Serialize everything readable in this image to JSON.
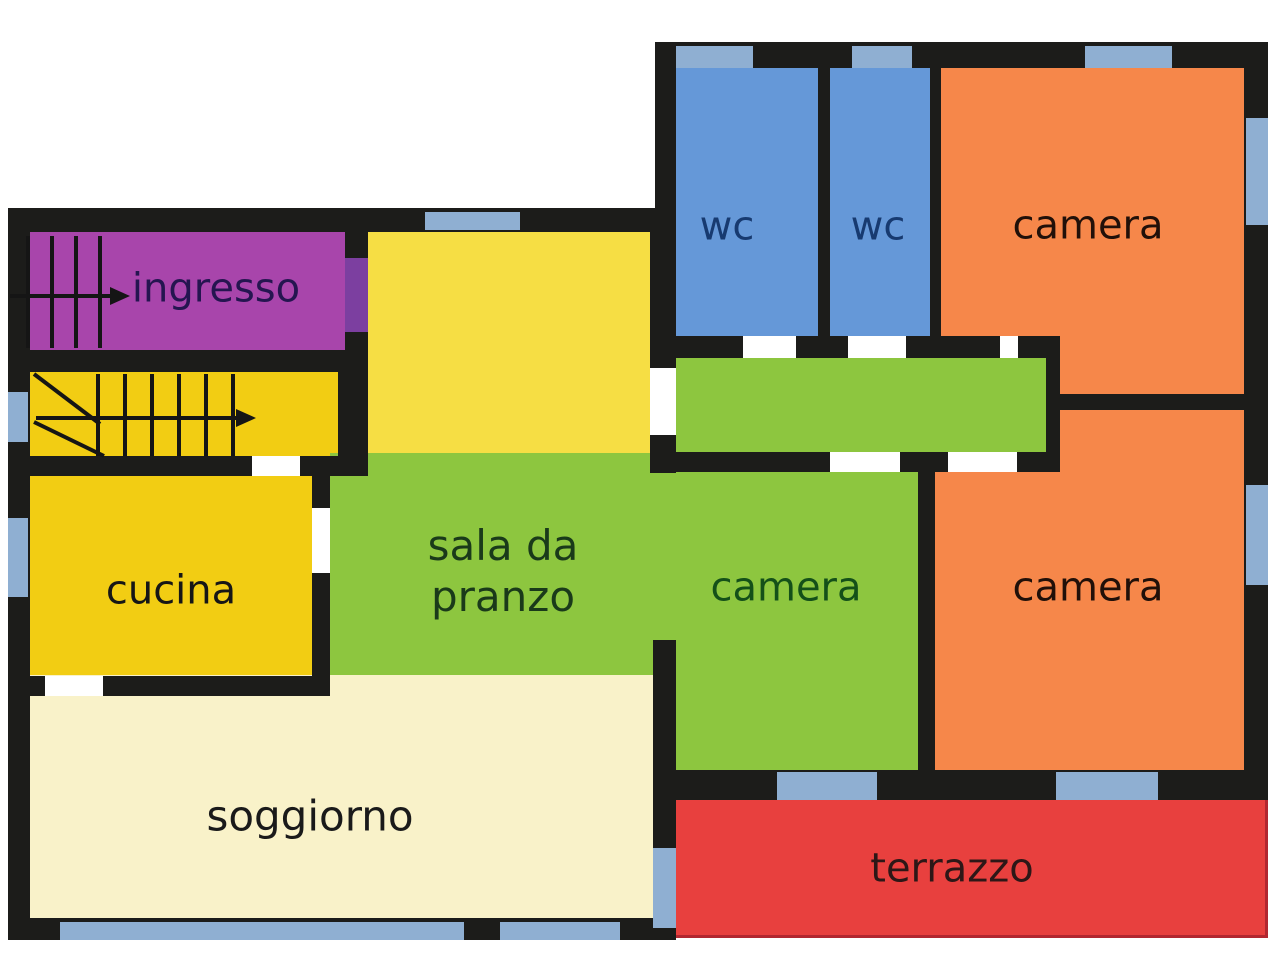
{
  "plan": {
    "width": 1280,
    "height": 960,
    "background": "#ffffff",
    "palette": {
      "wall": "#1c1c1a",
      "door_gap": "#ffffff",
      "window": "#8fafd2",
      "stair_line": "#151515",
      "purple": "#a845ab",
      "purple_door": "#7c3fa0",
      "gold": "#f2cd13",
      "light_yellow": "#f6de44",
      "green": "#8dc63f",
      "wc_blue": "#6598d8",
      "orange": "#f6874a",
      "red": "#e8403e",
      "cream": "#f9f2c9"
    }
  },
  "rooms": [
    {
      "id": "ingresso",
      "x": 20,
      "y": 230,
      "w": 325,
      "h": 122,
      "color": "#a845ab"
    },
    {
      "id": "upper-room",
      "x": 368,
      "y": 228,
      "w": 285,
      "h": 227,
      "color": "#f6de44"
    },
    {
      "id": "stairwell",
      "x": 30,
      "y": 372,
      "w": 308,
      "h": 86,
      "color": "#f2cd13"
    },
    {
      "id": "cucina",
      "x": 30,
      "y": 474,
      "w": 282,
      "h": 204,
      "color": "#f2cd13"
    },
    {
      "id": "sala-e-camera",
      "x": 330,
      "y": 453,
      "w": 588,
      "h": 322,
      "color": "#8dc63f"
    },
    {
      "id": "wc-1",
      "x": 676,
      "y": 68,
      "w": 142,
      "h": 268,
      "color": "#6598d8"
    },
    {
      "id": "wc-2",
      "x": 830,
      "y": 68,
      "w": 100,
      "h": 268,
      "color": "#6598d8"
    },
    {
      "id": "camera-top",
      "x": 941,
      "y": 68,
      "w": 303,
      "h": 330,
      "color": "#f6874a"
    },
    {
      "id": "camera-bottom",
      "x": 935,
      "y": 410,
      "w": 309,
      "h": 360,
      "color": "#f6874a"
    },
    {
      "id": "corridor",
      "x": 676,
      "y": 356,
      "w": 370,
      "h": 98,
      "color": "#8dc63f"
    },
    {
      "id": "soggiorno",
      "x": 30,
      "y": 675,
      "w": 623,
      "h": 245,
      "color": "#f9f2c9"
    },
    {
      "id": "terrazzo",
      "x": 676,
      "y": 798,
      "w": 592,
      "h": 140,
      "color": "#e8403e",
      "edge": "#b22730"
    }
  ],
  "labels": [
    {
      "id": "ingresso-label",
      "lines": [
        "ingresso"
      ],
      "x": 216,
      "y": 289,
      "color": "#251550",
      "size": 40
    },
    {
      "id": "cucina-label",
      "lines": [
        "cucina"
      ],
      "x": 171,
      "y": 591,
      "color": "#161616",
      "size": 40
    },
    {
      "id": "sala-pranzo-label",
      "lines": [
        "sala da",
        "pranzo"
      ],
      "x": 503,
      "y": 571,
      "color": "#1a3a1a",
      "size": 42
    },
    {
      "id": "camera-green-label",
      "lines": [
        "camera"
      ],
      "x": 786,
      "y": 588,
      "color": "#145019",
      "size": 40
    },
    {
      "id": "camera-orange-label",
      "lines": [
        "camera"
      ],
      "x": 1088,
      "y": 588,
      "color": "#211009",
      "size": 40
    },
    {
      "id": "camera-top-label",
      "lines": [
        "camera"
      ],
      "x": 1088,
      "y": 226,
      "color": "#211009",
      "size": 40
    },
    {
      "id": "wc-1-label",
      "lines": [
        "wc"
      ],
      "x": 727,
      "y": 227,
      "color": "#173a70",
      "size": 40
    },
    {
      "id": "wc-2-label",
      "lines": [
        "wc"
      ],
      "x": 878,
      "y": 227,
      "color": "#173a70",
      "size": 40
    },
    {
      "id": "soggiorno-label",
      "lines": [
        "soggiorno"
      ],
      "x": 310,
      "y": 816,
      "color": "#1a1a1a",
      "size": 42
    },
    {
      "id": "terrazzo-label",
      "lines": [
        "terrazzo"
      ],
      "x": 952,
      "y": 869,
      "color": "#2d1717",
      "size": 40
    }
  ],
  "walls": [
    {
      "x": 8,
      "y": 208,
      "w": 647,
      "h": 24
    },
    {
      "x": 8,
      "y": 208,
      "w": 22,
      "h": 732
    },
    {
      "x": 8,
      "y": 350,
      "w": 337,
      "h": 22
    },
    {
      "x": 345,
      "y": 230,
      "w": 23,
      "h": 120
    },
    {
      "x": 338,
      "y": 350,
      "w": 30,
      "h": 108
    },
    {
      "x": 8,
      "y": 456,
      "w": 360,
      "h": 20
    },
    {
      "x": 312,
      "y": 474,
      "w": 18,
      "h": 204
    },
    {
      "x": 8,
      "y": 676,
      "w": 322,
      "h": 20
    },
    {
      "x": 8,
      "y": 918,
      "w": 668,
      "h": 22
    },
    {
      "x": 653,
      "y": 640,
      "w": 23,
      "h": 300
    },
    {
      "x": 650,
      "y": 208,
      "w": 26,
      "h": 160
    },
    {
      "x": 650,
      "y": 435,
      "w": 26,
      "h": 38
    },
    {
      "x": 655,
      "y": 42,
      "w": 613,
      "h": 26
    },
    {
      "x": 1244,
      "y": 42,
      "w": 24,
      "h": 758
    },
    {
      "x": 655,
      "y": 42,
      "w": 21,
      "h": 168
    },
    {
      "x": 818,
      "y": 68,
      "w": 12,
      "h": 268
    },
    {
      "x": 930,
      "y": 68,
      "w": 11,
      "h": 270
    },
    {
      "x": 655,
      "y": 336,
      "w": 405,
      "h": 22
    },
    {
      "x": 1046,
      "y": 336,
      "w": 14,
      "h": 118
    },
    {
      "x": 1046,
      "y": 394,
      "w": 198,
      "h": 16
    },
    {
      "x": 655,
      "y": 452,
      "w": 405,
      "h": 20
    },
    {
      "x": 918,
      "y": 472,
      "w": 17,
      "h": 300
    },
    {
      "x": 655,
      "y": 770,
      "w": 589,
      "h": 30
    }
  ],
  "door_gaps": [
    {
      "x": 252,
      "y": 456,
      "w": 48,
      "h": 20
    },
    {
      "x": 312,
      "y": 508,
      "w": 18,
      "h": 65
    },
    {
      "x": 45,
      "y": 676,
      "w": 58,
      "h": 20
    },
    {
      "x": 650,
      "y": 368,
      "w": 26,
      "h": 67
    },
    {
      "x": 743,
      "y": 336,
      "w": 53,
      "h": 22
    },
    {
      "x": 848,
      "y": 336,
      "w": 58,
      "h": 22
    },
    {
      "x": 1000,
      "y": 336,
      "w": 18,
      "h": 22
    },
    {
      "x": 830,
      "y": 452,
      "w": 70,
      "h": 20
    },
    {
      "x": 948,
      "y": 452,
      "w": 69,
      "h": 20
    }
  ],
  "windows": [
    {
      "x": 425,
      "y": 212,
      "w": 95,
      "h": 18
    },
    {
      "x": 8,
      "y": 392,
      "w": 20,
      "h": 50
    },
    {
      "x": 8,
      "y": 518,
      "w": 20,
      "h": 79
    },
    {
      "x": 60,
      "y": 922,
      "w": 404,
      "h": 18
    },
    {
      "x": 500,
      "y": 922,
      "w": 120,
      "h": 18
    },
    {
      "x": 653,
      "y": 848,
      "w": 23,
      "h": 80
    },
    {
      "x": 676,
      "y": 46,
      "w": 77,
      "h": 22
    },
    {
      "x": 852,
      "y": 46,
      "w": 60,
      "h": 22
    },
    {
      "x": 1085,
      "y": 46,
      "w": 87,
      "h": 22
    },
    {
      "x": 1246,
      "y": 118,
      "w": 22,
      "h": 107
    },
    {
      "x": 1246,
      "y": 485,
      "w": 22,
      "h": 100
    },
    {
      "x": 777,
      "y": 772,
      "w": 100,
      "h": 28
    },
    {
      "x": 1056,
      "y": 772,
      "w": 102,
      "h": 28
    }
  ],
  "door_openings": [
    {
      "id": "ingresso-door",
      "x": 345,
      "y": 258,
      "w": 23,
      "h": 74,
      "color": "#7c3fa0"
    }
  ],
  "stairs": {
    "upper": {
      "risers_x": [
        28,
        52,
        76,
        100
      ],
      "riser_y1": 236,
      "riser_y2": 348,
      "arrow": {
        "x1": 10,
        "y1": 296,
        "x2": 110,
        "y2": 296,
        "head": 20
      }
    },
    "lower": {
      "risers_x": [
        98,
        125,
        152,
        179,
        206,
        233
      ],
      "riser_y1": 374,
      "riser_y2": 456,
      "diagonals": [
        {
          "x1": 34,
          "y1": 374,
          "x2": 100,
          "y2": 424
        },
        {
          "x1": 34,
          "y1": 422,
          "x2": 104,
          "y2": 456
        }
      ],
      "arrow": {
        "x1": 36,
        "y1": 418,
        "x2": 236,
        "y2": 418,
        "head": 20
      }
    }
  }
}
